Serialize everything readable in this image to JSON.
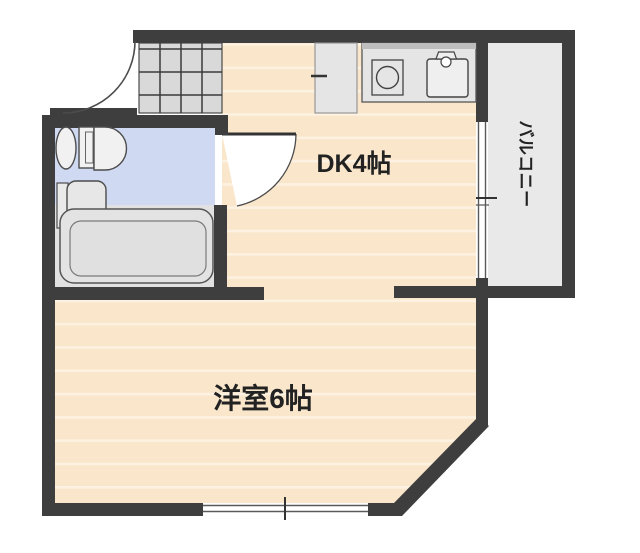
{
  "type": "floor-plan",
  "labels": {
    "dining_kitchen": "DK4帖",
    "western_room": "洋室6帖",
    "balcony": "バルコニー"
  },
  "rooms": [
    {
      "name": "dining-kitchen",
      "label": "DK4帖"
    },
    {
      "name": "western-room",
      "label": "洋室6帖"
    },
    {
      "name": "balcony",
      "label": "バルコニー"
    },
    {
      "name": "bathroom",
      "label": ""
    },
    {
      "name": "entry",
      "label": ""
    }
  ],
  "fixtures": [
    "toilet-icon",
    "washbasin-icon",
    "bathtub-icon",
    "kitchen-sink-icon",
    "stove-icon",
    "refrigerator-space",
    "entry-tile-grid",
    "entrance-door-swing",
    "bathroom-door-swing",
    "balcony-sliding-window",
    "room-sliding-window"
  ],
  "colors": {
    "wall": "#3e3e3e",
    "floor": "#fae7cb",
    "stripe": "#fdf2e1",
    "bathfloor": "#cfdaf2",
    "tubfloor": "#e1e1e1",
    "balconyfloor": "#e9e9e9",
    "tile": "#d9d9d9",
    "fixture": "#f1f1f1",
    "counter": "#e5e5e5",
    "counteredge": "#bdbdbd",
    "outline": "#4c4c4c",
    "text": "#222222"
  }
}
